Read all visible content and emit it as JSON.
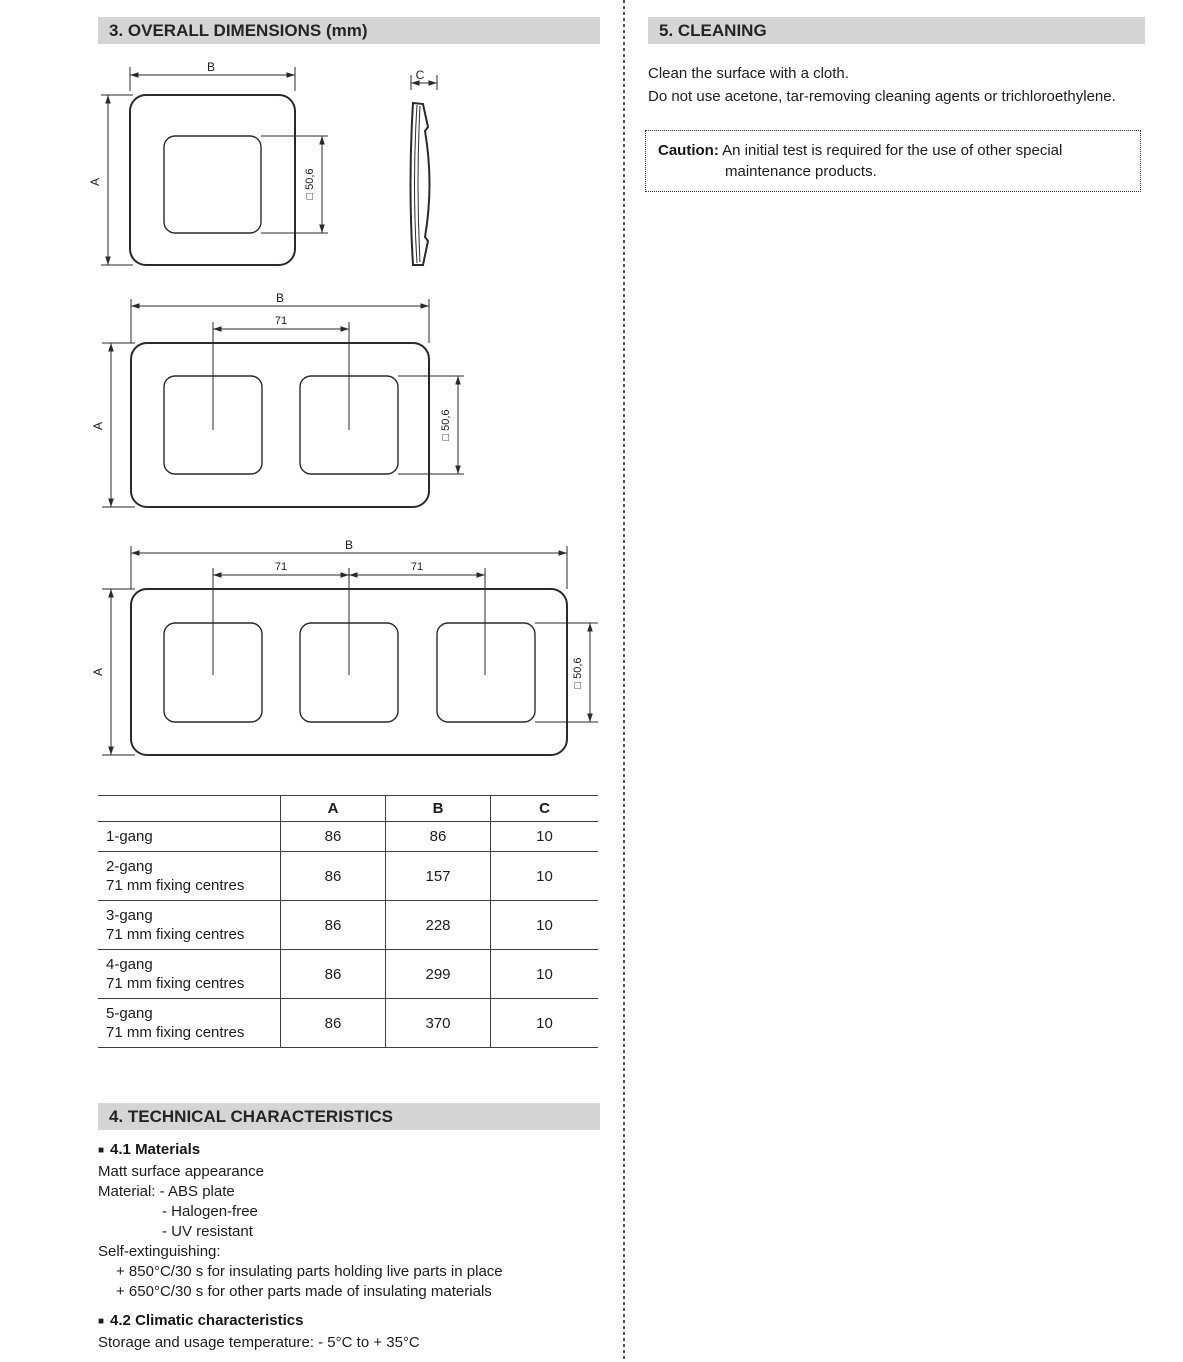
{
  "colors": {
    "header_bg": "#d5d5d5",
    "text": "#1c1c1c",
    "line": "#2a2a2a"
  },
  "dims": {
    "A": "A",
    "B": "B",
    "C": "C",
    "spacing71": "71",
    "square506": "□ 50,6"
  },
  "section3": {
    "title": "3. OVERALL DIMENSIONS (mm)"
  },
  "table": {
    "col_a": "A",
    "col_b": "B",
    "col_c": "C",
    "rows": [
      {
        "label": "1-gang",
        "a": "86",
        "b": "86",
        "c": "10"
      },
      {
        "label": "2-gang\n71 mm fixing centres",
        "a": "86",
        "b": "157",
        "c": "10"
      },
      {
        "label": "3-gang\n71 mm fixing centres",
        "a": "86",
        "b": "228",
        "c": "10"
      },
      {
        "label": "4-gang\n71 mm fixing centres",
        "a": "86",
        "b": "299",
        "c": "10"
      },
      {
        "label": "5-gang\n71 mm fixing centres",
        "a": "86",
        "b": "370",
        "c": "10"
      }
    ]
  },
  "section4": {
    "title": "4. TECHNICAL CHARACTERISTICS",
    "bullet": "■",
    "materials_heading": "4.1 Materials",
    "m1": "Matt surface appearance",
    "m2": "Material: - ABS plate",
    "m3": "- Halogen-free",
    "m4": "- UV resistant",
    "m5": "Self-extinguishing:",
    "m6": "+ 850°C/30 s for insulating parts holding live parts in place",
    "m7": "+ 650°C/30 s for other parts made of insulating materials",
    "climatic_heading": "4.2 Climatic characteristics",
    "c1": "Storage and usage temperature: - 5°C to + 35°C"
  },
  "section5": {
    "title": "5. CLEANING",
    "line1": "Clean the surface with a cloth.",
    "line2": "Do not use acetone, tar-removing cleaning agents or trichloroethylene."
  },
  "caution": {
    "label": "Caution:",
    "line1": "An initial test is required for the use of other special",
    "line2": "maintenance products."
  }
}
